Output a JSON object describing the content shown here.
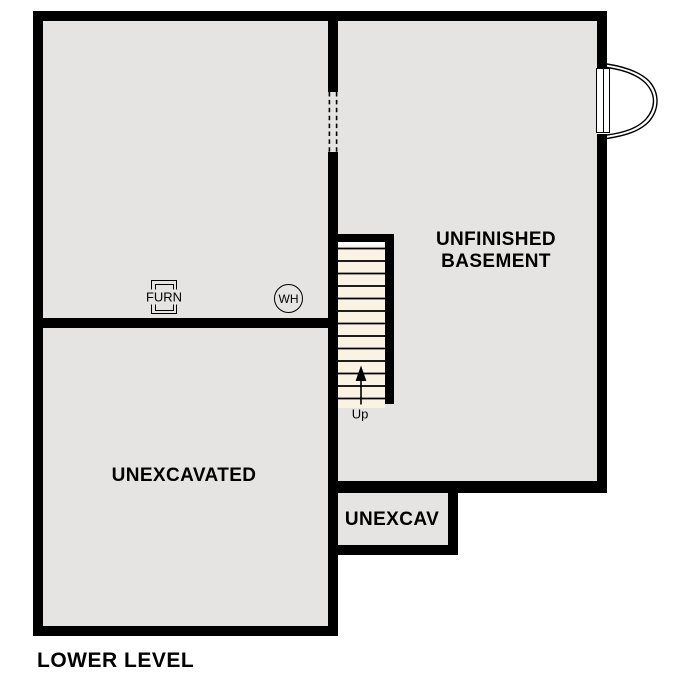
{
  "plan": {
    "title": "LOWER LEVEL",
    "rooms": {
      "basement": {
        "name_line1": "UNFINISHED",
        "name_line2": "BASEMENT"
      },
      "unexcavated": {
        "name": "UNEXCAVATED"
      },
      "crawlspace": {
        "name": "UNEXCAV"
      }
    },
    "stairs": {
      "direction_label": "Up",
      "tread_count": 13
    },
    "equipment": {
      "furnace_label": "FURN",
      "water_heater_label": "WH"
    },
    "colors": {
      "wall": "#000000",
      "room_fill": "#e6e4e2",
      "stair_fill": "#faf3e3",
      "background": "#ffffff"
    }
  }
}
